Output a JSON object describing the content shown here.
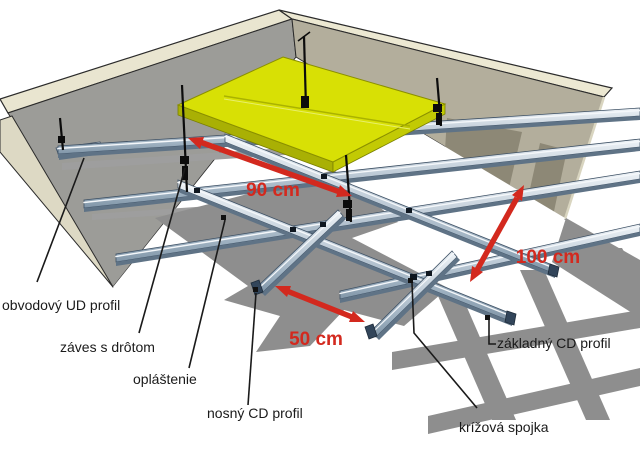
{
  "diagram": {
    "title": "suspended ceiling construction diagram",
    "labels": {
      "perimeter_ud_profile": "obvodový UD profil",
      "hanger_with_wire": "záves s drôtom",
      "cladding": "opláštenie",
      "bearing_cd_profile": "nosný CD profil",
      "cross_connector": "krížová spojka",
      "base_cd_profile": "základný CD profil"
    },
    "dimensions": {
      "d90": "90 cm",
      "d50": "50 cm",
      "d100": "100 cm"
    },
    "colors": {
      "dimension_red": "#d3291e",
      "insulation_yellow": "#d8e005",
      "insulation_edge_dark": "#a9b004",
      "wall_edge_beige": "#e9e5d0",
      "left_wall_gray": "#9c9c98",
      "right_wall_tan": "#b3ae9c",
      "shadow_gray": "#8e8e8e",
      "profile_steel": "#b6c4d2",
      "line_black": "#1a1a1a"
    }
  }
}
